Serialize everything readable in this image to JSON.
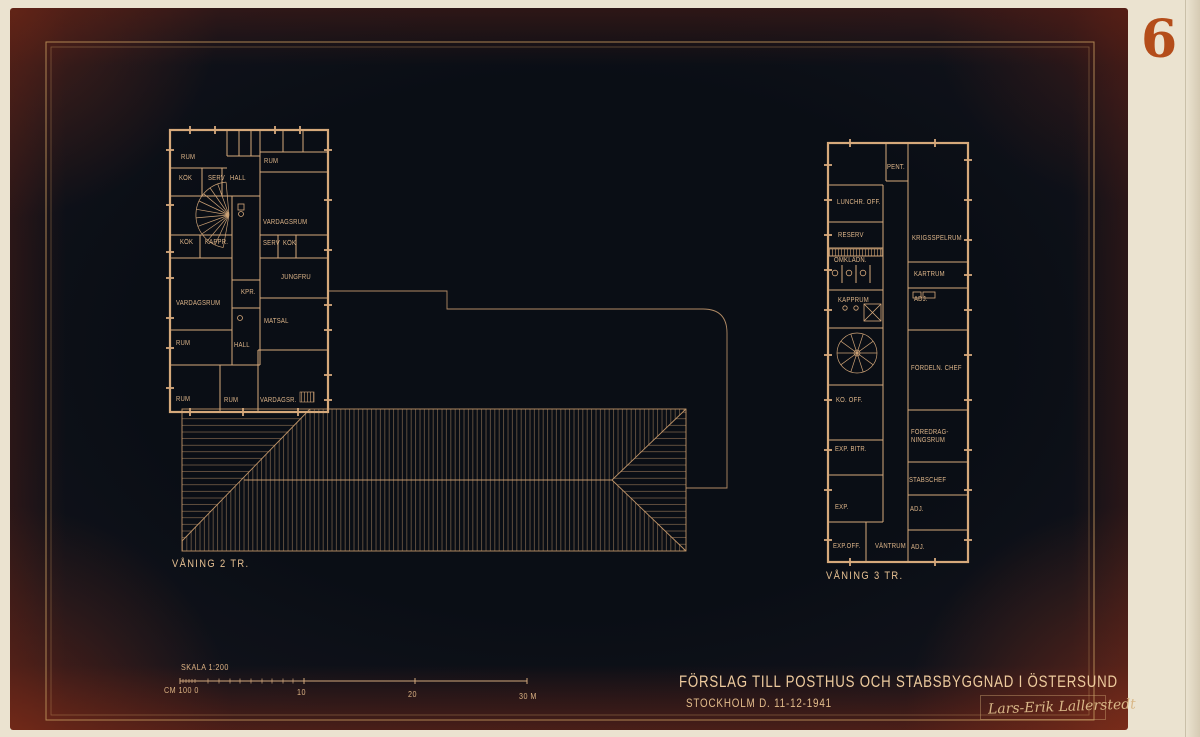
{
  "plate": {
    "number": "6"
  },
  "title_block": {
    "title": "FÖRSLAG TILL POSTHUS OCH STABSBYGGNAD I ÖSTERSUND",
    "date_line": "STOCKHOLM D. 11-12-1941",
    "signature": "Lars-Erik Lallerstedt"
  },
  "scale_bar": {
    "label": "SKALA 1:200",
    "zero_label": "CM 100 0",
    "tick_labels": [
      "10",
      "20",
      "30 M"
    ]
  },
  "plans": [
    {
      "caption": "VÅNING 2 TR.",
      "rooms": [
        {
          "label": "RUM",
          "x": 181,
          "y": 154
        },
        {
          "label": "KÖK",
          "x": 179,
          "y": 175
        },
        {
          "label": "SERV",
          "x": 208,
          "y": 175
        },
        {
          "label": "HALL",
          "x": 230,
          "y": 175
        },
        {
          "label": "RUM",
          "x": 264,
          "y": 158
        },
        {
          "label": "VARDAGSRUM",
          "x": 263,
          "y": 219
        },
        {
          "label": "KÖK",
          "x": 180,
          "y": 239
        },
        {
          "label": "KAPPR.",
          "x": 205,
          "y": 239
        },
        {
          "label": "SERV",
          "x": 263,
          "y": 240
        },
        {
          "label": "KÖK",
          "x": 283,
          "y": 240
        },
        {
          "label": "JUNGFRU",
          "x": 281,
          "y": 274
        },
        {
          "label": "KPR.",
          "x": 241,
          "y": 289
        },
        {
          "label": "VARDAGSRUM",
          "x": 176,
          "y": 300
        },
        {
          "label": "MATSAL",
          "x": 264,
          "y": 318
        },
        {
          "label": "RUM",
          "x": 176,
          "y": 340
        },
        {
          "label": "HALL",
          "x": 234,
          "y": 342
        },
        {
          "label": "RUM",
          "x": 176,
          "y": 396
        },
        {
          "label": "RUM",
          "x": 224,
          "y": 397
        },
        {
          "label": "VARDAGSR.",
          "x": 260,
          "y": 397
        }
      ]
    },
    {
      "caption": "VÅNING 3 TR.",
      "rooms": [
        {
          "label": "PENT.",
          "x": 887,
          "y": 164
        },
        {
          "label": "LUNCHR. OFF.",
          "x": 837,
          "y": 199
        },
        {
          "label": "RESERV",
          "x": 838,
          "y": 232
        },
        {
          "label": "OMKLÄDN.",
          "x": 834,
          "y": 257
        },
        {
          "label": "KRIGSSPELRUM",
          "x": 912,
          "y": 235
        },
        {
          "label": "KARTRUM",
          "x": 914,
          "y": 271
        },
        {
          "label": "KAPPRUM",
          "x": 838,
          "y": 297
        },
        {
          "label": "ADJ.",
          "x": 914,
          "y": 296
        },
        {
          "label": "FÖRDELN. CHEF",
          "x": 911,
          "y": 365
        },
        {
          "label": "KO. OFF.",
          "x": 836,
          "y": 397
        },
        {
          "label": "EXP. BITR.",
          "x": 835,
          "y": 446
        },
        {
          "label": "FÖREDRAG-\nNINGSRUM",
          "x": 911,
          "y": 429
        },
        {
          "label": "STABSCHEF",
          "x": 909,
          "y": 477
        },
        {
          "label": "EXP.",
          "x": 835,
          "y": 504
        },
        {
          "label": "ADJ.",
          "x": 910,
          "y": 506
        },
        {
          "label": "EXP.OFF.",
          "x": 833,
          "y": 543
        },
        {
          "label": "VÄNTRUM",
          "x": 875,
          "y": 543
        },
        {
          "label": "ADJ.",
          "x": 911,
          "y": 544
        }
      ]
    }
  ],
  "colors": {
    "paper": "#ebe3d0",
    "plate_center": "#0a0e15",
    "plate_vignette": "#471b15",
    "line_ink": "#d6a97b",
    "label_text": "#dfb68a",
    "frame_gold": "#bb9059",
    "plate_number": "#b44d1a"
  }
}
